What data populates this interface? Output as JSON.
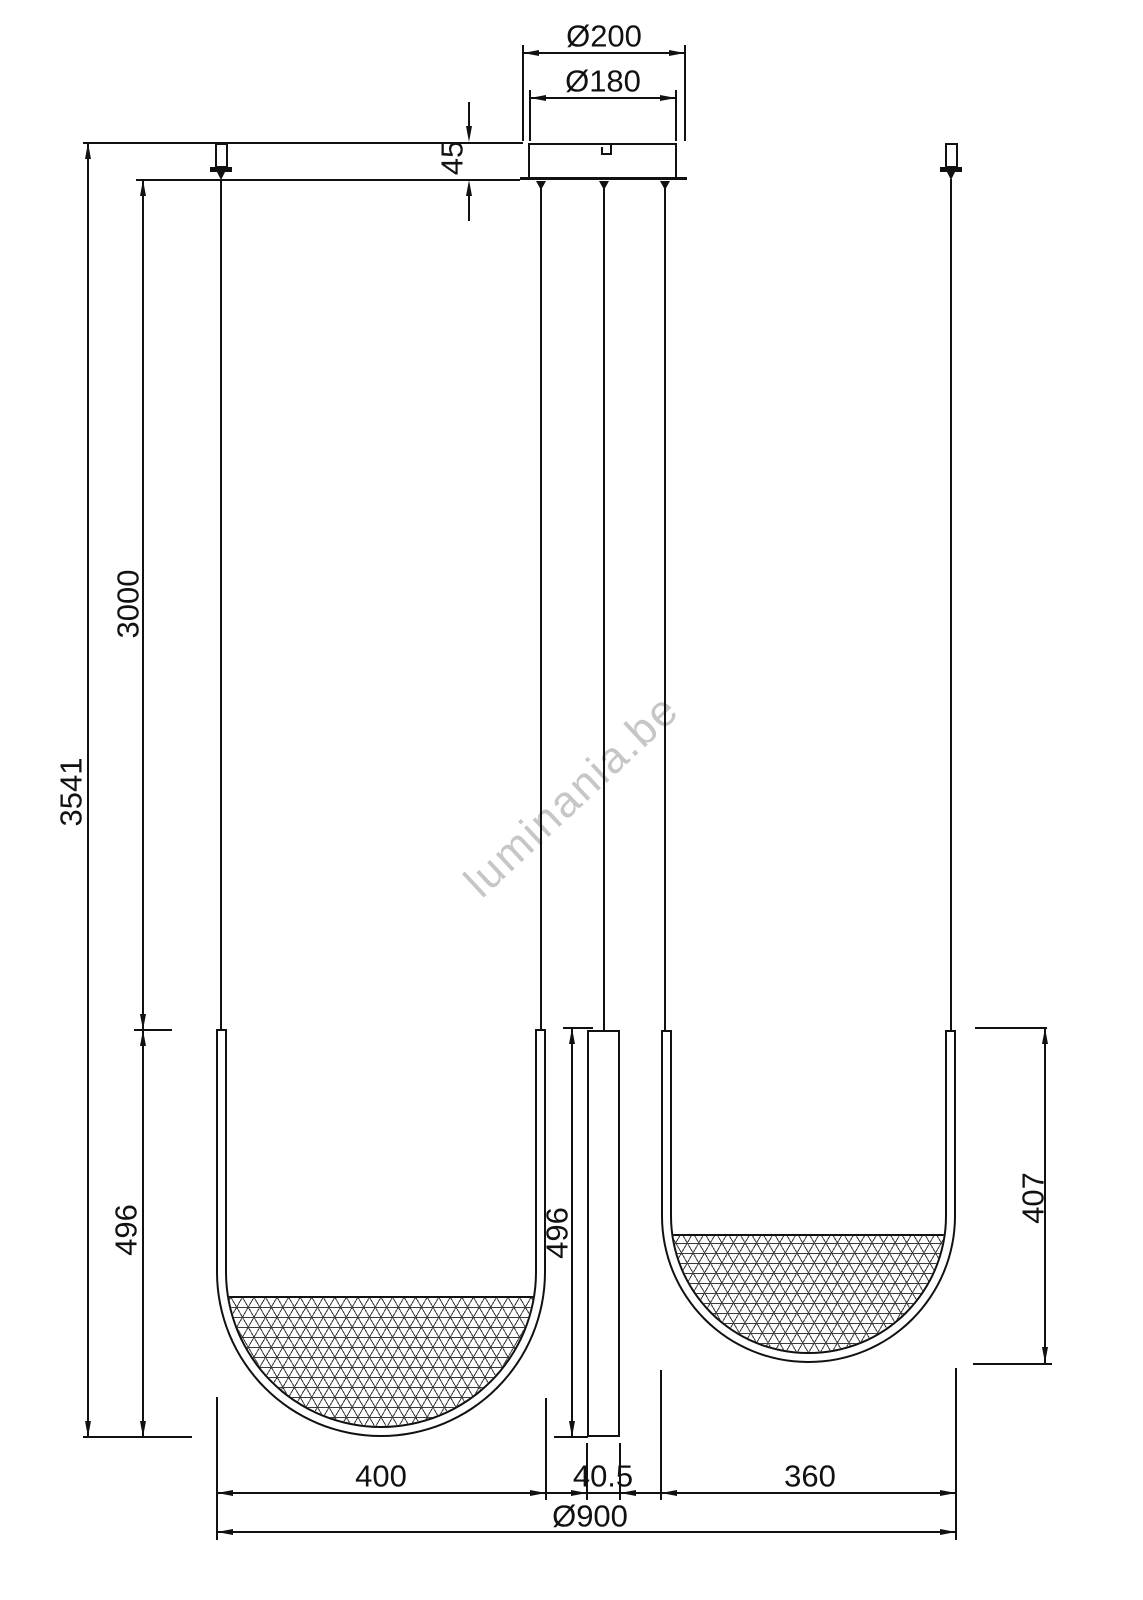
{
  "title": "pendant-light-dimension-drawing",
  "watermark": "luminania.be",
  "labels": {
    "canopy_diameter_outer": "Ø200",
    "canopy_diameter_inner": "Ø180",
    "canopy_height": "45",
    "overall_drop": "3541",
    "suspension_length": "3000",
    "left_pendant_depth": "496",
    "center_tube_length": "496",
    "right_pendant_depth": "407",
    "left_pendant_width": "400",
    "center_tube_width": "40.5",
    "right_pendant_width": "360",
    "overall_diameter": "Ø900"
  },
  "colors": {
    "line": "#111111",
    "watermark": "#c6c6c6",
    "background": "#ffffff"
  }
}
